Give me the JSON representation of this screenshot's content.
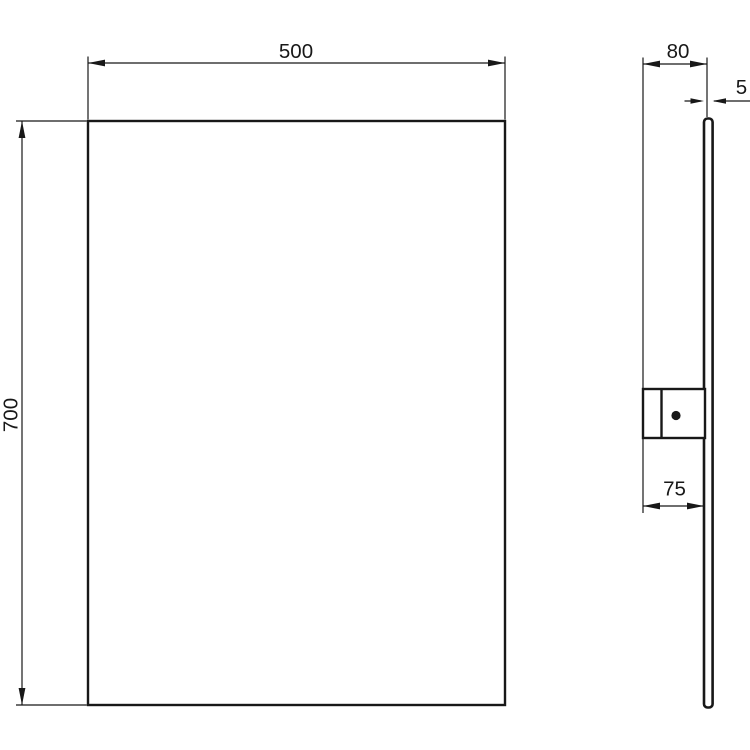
{
  "drawing": {
    "background_color": "#ffffff",
    "line_color": "#181818",
    "dimensions": {
      "width": "500",
      "height": "700",
      "depth": "80",
      "thickness": "5",
      "bracket_offset": "75"
    }
  }
}
